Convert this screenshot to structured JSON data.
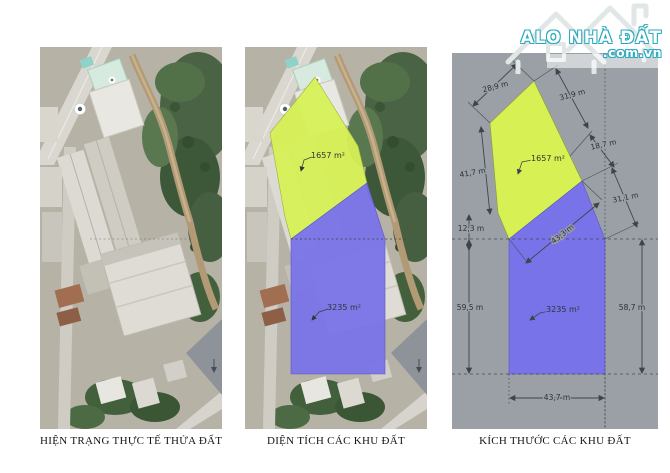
{
  "logo": {
    "brand": "ALO NHÀ ĐẤT",
    "domain": ".com.vn",
    "accent_color": "#2ba9be"
  },
  "panels": {
    "p1": {
      "caption": "HIỆN TRẠNG THỰC TẾ THỬA ĐẤT"
    },
    "p2": {
      "caption": "DIỆN TÍCH CÁC KHU ĐẤT"
    },
    "p3": {
      "caption": "KÍCH THƯỚC CÁC KHU ĐẤT"
    }
  },
  "zones": {
    "yellow": {
      "area": "1657 m²",
      "color": "#d7f155"
    },
    "blue": {
      "area": "3235 m²",
      "color": "#7873e8"
    }
  },
  "dimensions": [
    {
      "label": "28,9 m",
      "x": 44,
      "y": 36,
      "rot": -15
    },
    {
      "label": "31,9 m",
      "x": 121,
      "y": 44,
      "rot": -15
    },
    {
      "label": "18,7 m",
      "x": 152,
      "y": 94,
      "rot": -12
    },
    {
      "label": "41,7 m",
      "x": 21,
      "y": 122,
      "rot": -10
    },
    {
      "label": "12,3 m",
      "x": 19,
      "y": 178,
      "rot": 0
    },
    {
      "label": "43,3 m",
      "x": 112,
      "y": 183,
      "rot": -38
    },
    {
      "label": "31,1 m",
      "x": 174,
      "y": 147,
      "rot": -12
    },
    {
      "label": "59,5 m",
      "x": 18,
      "y": 257,
      "rot": 0
    },
    {
      "label": "58,7 m",
      "x": 180,
      "y": 257,
      "rot": 0
    },
    {
      "label": "43,7 m",
      "x": 105,
      "y": 347,
      "rot": 0
    }
  ]
}
